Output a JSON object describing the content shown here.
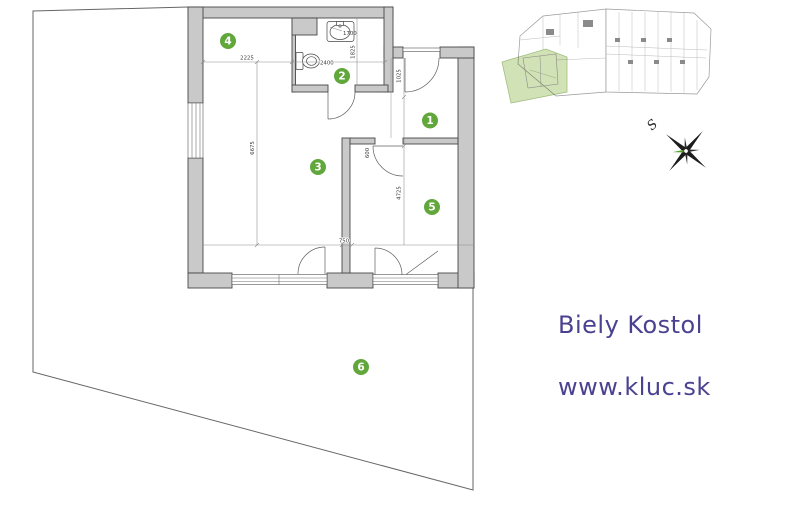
{
  "branding": {
    "location": "Biely Kostol",
    "website": "www.kluc.sk",
    "text_color": "#4a4290"
  },
  "compass": {
    "north_label": "S"
  },
  "colors": {
    "wall_fill": "#c9c9c9",
    "badge_green": "#61a73b",
    "plot_green": "#c9dda9"
  },
  "floor_plan": {
    "rooms": [
      {
        "number": "1"
      },
      {
        "number": "2"
      },
      {
        "number": "3"
      },
      {
        "number": "4"
      },
      {
        "number": "5"
      },
      {
        "number": "6"
      }
    ],
    "dimensions": {
      "kitchen_width": "2225",
      "living_length": "6675",
      "sink": "1700",
      "bathroom_width": "2400",
      "bathroom_length": "1825",
      "hall_width": "1025",
      "bedroom_door": "600",
      "bedroom_length": "4725",
      "pier": "750"
    }
  }
}
